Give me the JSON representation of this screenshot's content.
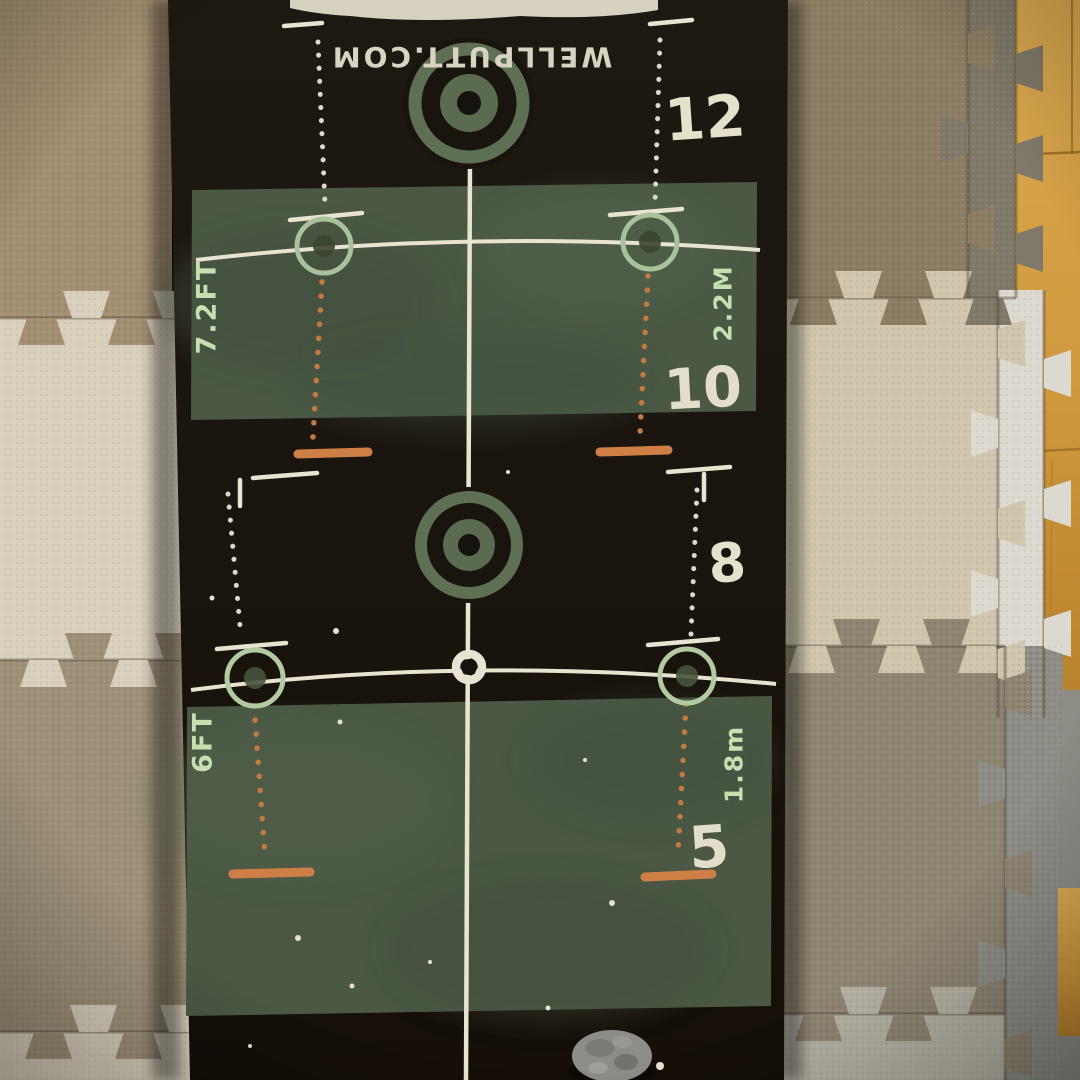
{
  "scene": {
    "description": "Photograph of a Wellputt golf putting training mat lying on interlocking foam puzzle floor tiles, with wooden flooring visible along the top-right edge and a small gray object resting on the mat at the bottom."
  },
  "mat": {
    "brand": "WELLPUTT.COM",
    "distance_labels": {
      "d12": "12",
      "d10": "10",
      "d8": "8",
      "d5": "5"
    },
    "measure_labels": {
      "top_left": "7.2FT",
      "top_right": "2.2M",
      "bottom_left": "6FT",
      "bottom_right": "1.8m"
    },
    "colors": {
      "mat_black": "#1a140e",
      "green_zone": "#4a5844",
      "guide_line_white": "#e9e4d1",
      "pale_ring_green": "#a9c29b",
      "pale_text_green": "#c9dfb0",
      "bullseye_green": "#5c6e52",
      "accent_orange": "#c97c42"
    }
  },
  "floor": {
    "colors": {
      "tile_tan": "#a28e71",
      "tile_cream": "#d8cfbc",
      "tile_taupe_left": "#9c9078",
      "tile_tan_right": "#8a7d63",
      "tile_gray_strip": "#7f7969",
      "tile_cream_right": "#cfc6ad",
      "tile_white_strip": "#dcd9d0",
      "tile_taupe_right": "#8d8471",
      "tile_gray_column": "#8d8d86",
      "tile_light_gray_bottom": "#b4b1a4",
      "wood_light": "#dcaa52",
      "wood_dark": "#b9822e"
    }
  }
}
